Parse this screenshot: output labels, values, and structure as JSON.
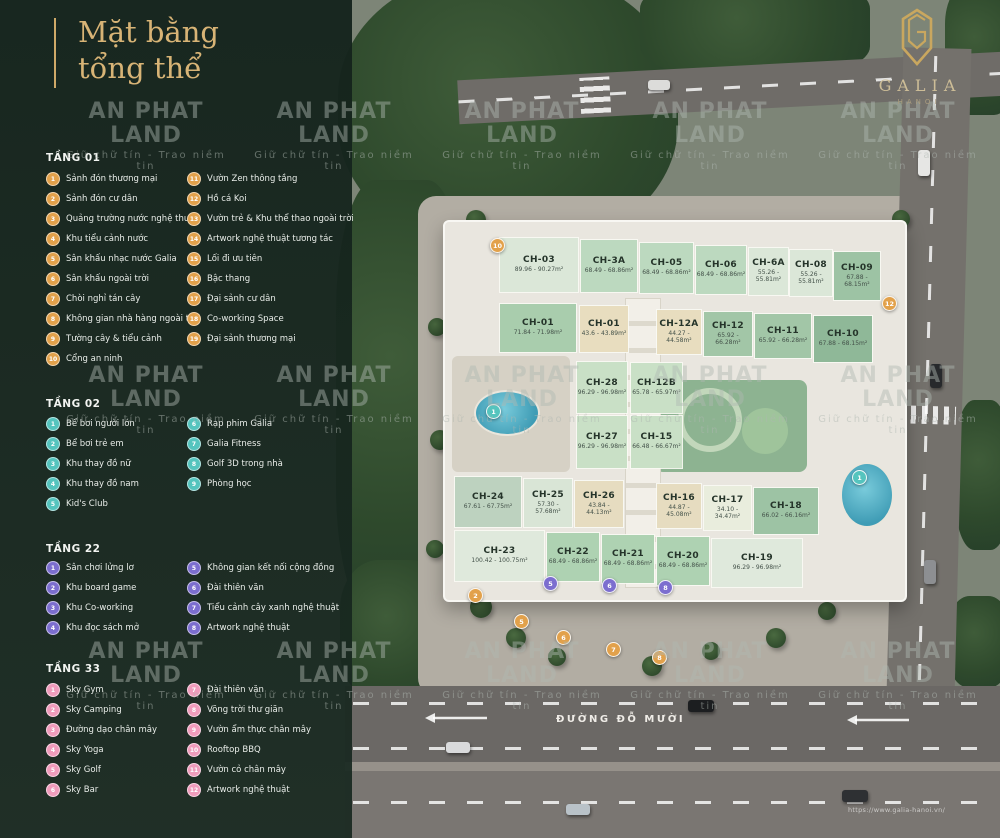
{
  "title": {
    "line1": "Mặt bằng",
    "line2": "tổng thể"
  },
  "logo": {
    "brand": "GALIA",
    "city": "HANOI"
  },
  "watermark": {
    "brand": "AN PHAT LAND",
    "tagline": "Giữ chữ tín  -  Trao niềm tin"
  },
  "legend_sections": [
    {
      "id": "tang-01",
      "title": "TẦNG 01",
      "circle_bg": "#E2A14B",
      "columns": [
        [
          {
            "n": "1",
            "label": "Sảnh đón thương mại"
          },
          {
            "n": "2",
            "label": "Sảnh đón cư dân"
          },
          {
            "n": "3",
            "label": "Quảng trường nước nghệ thuật"
          },
          {
            "n": "4",
            "label": "Khu tiểu cảnh nước"
          },
          {
            "n": "5",
            "label": "Sân khấu nhạc nước Galia"
          },
          {
            "n": "6",
            "label": "Sân khấu ngoài trời"
          },
          {
            "n": "7",
            "label": "Chòi nghỉ tán cây"
          },
          {
            "n": "8",
            "label": "Không gian nhà hàng ngoài trời"
          },
          {
            "n": "9",
            "label": "Tường cây & tiểu cảnh"
          },
          {
            "n": "10",
            "label": "Cổng an ninh"
          }
        ],
        [
          {
            "n": "11",
            "label": "Vườn Zen thông tầng"
          },
          {
            "n": "12",
            "label": "Hồ cá Koi"
          },
          {
            "n": "13",
            "label": "Vườn trẻ & Khu thể thao ngoài trời"
          },
          {
            "n": "14",
            "label": "Artwork nghệ thuật tương tác"
          },
          {
            "n": "15",
            "label": "Lối đi ưu tiên"
          },
          {
            "n": "16",
            "label": "Bậc thang"
          },
          {
            "n": "17",
            "label": "Đại sảnh cư dân"
          },
          {
            "n": "18",
            "label": "Co-working Space"
          },
          {
            "n": "19",
            "label": "Đại sảnh thương mại"
          }
        ]
      ]
    },
    {
      "id": "tang-02",
      "title": "TẦNG 02",
      "circle_bg": "#55C4BE",
      "columns": [
        [
          {
            "n": "1",
            "label": "Bể bơi người lớn"
          },
          {
            "n": "2",
            "label": "Bể bơi trẻ em"
          },
          {
            "n": "3",
            "label": "Khu thay đồ nữ"
          },
          {
            "n": "4",
            "label": "Khu thay đồ nam"
          },
          {
            "n": "5",
            "label": "Kid's Club"
          }
        ],
        [
          {
            "n": "6",
            "label": "Rạp phim Galia"
          },
          {
            "n": "7",
            "label": "Galia Fitness"
          },
          {
            "n": "8",
            "label": "Golf 3D trong nhà"
          },
          {
            "n": "9",
            "label": "Phòng học"
          }
        ]
      ]
    },
    {
      "id": "tang-22",
      "title": "TẦNG 22",
      "circle_bg": "#7C6ECF",
      "columns": [
        [
          {
            "n": "1",
            "label": "Sân chơi lửng lơ"
          },
          {
            "n": "2",
            "label": "Khu board game"
          },
          {
            "n": "3",
            "label": "Khu Co-working"
          },
          {
            "n": "4",
            "label": "Khu đọc sách mở"
          }
        ],
        [
          {
            "n": "5",
            "label": "Không gian kết nối cộng đồng"
          },
          {
            "n": "6",
            "label": "Đài thiên văn"
          },
          {
            "n": "7",
            "label": "Tiểu cảnh cây xanh nghệ thuật"
          },
          {
            "n": "8",
            "label": "Artwork nghệ thuật"
          }
        ]
      ]
    },
    {
      "id": "tang-33",
      "title": "TẦNG 33",
      "circle_bg": "#F09CBC",
      "columns": [
        [
          {
            "n": "1",
            "label": "Sky Gym"
          },
          {
            "n": "2",
            "label": "Sky Camping"
          },
          {
            "n": "3",
            "label": "Đường dạo chân mây"
          },
          {
            "n": "4",
            "label": "Sky Yoga"
          },
          {
            "n": "5",
            "label": "Sky Golf"
          },
          {
            "n": "6",
            "label": "Sky Bar"
          }
        ],
        [
          {
            "n": "7",
            "label": "Đài thiên văn"
          },
          {
            "n": "8",
            "label": "Võng trời thư giãn"
          },
          {
            "n": "9",
            "label": "Vườn ẩm thực chân mây"
          },
          {
            "n": "10",
            "label": "Rooftop BBQ"
          },
          {
            "n": "11",
            "label": "Vườn cỏ chân mây"
          },
          {
            "n": "12",
            "label": "Artwork nghệ thuật"
          }
        ]
      ]
    }
  ],
  "map": {
    "road_label": "ĐƯỜNG ĐỖ MƯỜI",
    "url": "https://www.galia-hanoi.vn/",
    "units": [
      {
        "id": "CH-03",
        "area": "89.96 - 90.27m²",
        "x": 500,
        "y": 238,
        "w": 78,
        "h": 54,
        "bg": "#dbe7d8"
      },
      {
        "id": "CH-3A",
        "area": "68.49 - 68.86m²",
        "x": 581,
        "y": 240,
        "w": 56,
        "h": 52,
        "bg": "#bcd9bf"
      },
      {
        "id": "CH-05",
        "area": "68.49 - 68.86m²",
        "x": 640,
        "y": 243,
        "w": 53,
        "h": 50,
        "bg": "#bcd9bf"
      },
      {
        "id": "CH-06",
        "area": "68.49 - 68.86m²",
        "x": 696,
        "y": 246,
        "w": 50,
        "h": 48,
        "bg": "#bcd9bf"
      },
      {
        "id": "CH-6A",
        "area": "55.26 - 55.81m²",
        "x": 749,
        "y": 248,
        "w": 39,
        "h": 47,
        "bg": "#dbe7d8"
      },
      {
        "id": "CH-08",
        "area": "55.26 - 55.81m²",
        "x": 790,
        "y": 250,
        "w": 42,
        "h": 46,
        "bg": "#dbe7d8"
      },
      {
        "id": "CH-09",
        "area": "67.88 - 68.15m²",
        "x": 834,
        "y": 252,
        "w": 46,
        "h": 48,
        "bg": "#9dc3a4"
      },
      {
        "id": "CH-01",
        "area": "71.84 - 71.98m²",
        "x": 500,
        "y": 304,
        "w": 76,
        "h": 48,
        "bg": "#a9cdad"
      },
      {
        "id": "CH-01",
        "area": "43.6 - 43.89m²",
        "x": 580,
        "y": 306,
        "w": 48,
        "h": 46,
        "bg": "#e8ddbf"
      },
      {
        "id": "CH-12A",
        "area": "44.27 - 44.58m²",
        "x": 657,
        "y": 310,
        "w": 44,
        "h": 44,
        "bg": "#e8ddbf"
      },
      {
        "id": "CH-12",
        "area": "65.92 - 66.28m²",
        "x": 704,
        "y": 312,
        "w": 48,
        "h": 44,
        "bg": "#a2c6a7"
      },
      {
        "id": "CH-11",
        "area": "65.92 - 66.28m²",
        "x": 755,
        "y": 314,
        "w": 56,
        "h": 44,
        "bg": "#a2c6a7"
      },
      {
        "id": "CH-10",
        "area": "67.88 - 68.15m²",
        "x": 814,
        "y": 316,
        "w": 58,
        "h": 46,
        "bg": "#8fb898"
      },
      {
        "id": "CH-28",
        "area": "96.29 - 96.98m²",
        "x": 577,
        "y": 362,
        "w": 50,
        "h": 51,
        "bg": "#c9e0c6"
      },
      {
        "id": "CH-12B",
        "area": "65.78 - 65.97m²",
        "x": 631,
        "y": 363,
        "w": 51,
        "h": 50,
        "bg": "#c9e0c6"
      },
      {
        "id": "CH-27",
        "area": "96.29 - 96.98m²",
        "x": 577,
        "y": 416,
        "w": 50,
        "h": 52,
        "bg": "#c9e0c6"
      },
      {
        "id": "CH-15",
        "area": "66.48 - 66.67m²",
        "x": 631,
        "y": 416,
        "w": 51,
        "h": 52,
        "bg": "#c9e0c6"
      },
      {
        "id": "CH-24",
        "area": "67.61 - 67.75m²",
        "x": 455,
        "y": 477,
        "w": 66,
        "h": 50,
        "bg": "#bdd2bf"
      },
      {
        "id": "CH-25",
        "area": "57.30 - 57.68m²",
        "x": 524,
        "y": 479,
        "w": 48,
        "h": 48,
        "bg": "#d9e5d6"
      },
      {
        "id": "CH-26",
        "area": "43.84 - 44.13m²",
        "x": 575,
        "y": 481,
        "w": 48,
        "h": 46,
        "bg": "#e6dcc0"
      },
      {
        "id": "CH-16",
        "area": "44.87 - 45.08m²",
        "x": 657,
        "y": 484,
        "w": 44,
        "h": 44,
        "bg": "#e6dcc0"
      },
      {
        "id": "CH-17",
        "area": "34.10 - 34.47m²",
        "x": 704,
        "y": 486,
        "w": 47,
        "h": 44,
        "bg": "#e9eddd"
      },
      {
        "id": "CH-18",
        "area": "66.02 - 66.16m²",
        "x": 754,
        "y": 488,
        "w": 64,
        "h": 46,
        "bg": "#9dc3a4"
      },
      {
        "id": "CH-23",
        "area": "100.42 - 100.75m²",
        "x": 455,
        "y": 531,
        "w": 89,
        "h": 50,
        "bg": "#dfe9dc"
      },
      {
        "id": "CH-22",
        "area": "68.49 - 68.86m²",
        "x": 547,
        "y": 533,
        "w": 52,
        "h": 48,
        "bg": "#aed2b2"
      },
      {
        "id": "CH-21",
        "area": "68.49 - 68.86m²",
        "x": 602,
        "y": 535,
        "w": 52,
        "h": 48,
        "bg": "#aed2b2"
      },
      {
        "id": "CH-20",
        "area": "68.49 - 68.86m²",
        "x": 657,
        "y": 537,
        "w": 52,
        "h": 48,
        "bg": "#aed2b2"
      },
      {
        "id": "CH-19",
        "area": "96.29 - 96.98m²",
        "x": 712,
        "y": 539,
        "w": 90,
        "h": 48,
        "bg": "#dfe9dc"
      }
    ],
    "markers": [
      {
        "n": "10",
        "color": "#E2A14B",
        "x": 490,
        "y": 238
      },
      {
        "n": "12",
        "color": "#E2A14B",
        "x": 882,
        "y": 296
      },
      {
        "n": "2",
        "color": "#E2A14B",
        "x": 468,
        "y": 588
      },
      {
        "n": "5",
        "color": "#E2A14B",
        "x": 514,
        "y": 614
      },
      {
        "n": "6",
        "color": "#E2A14B",
        "x": 556,
        "y": 630
      },
      {
        "n": "7",
        "color": "#E2A14B",
        "x": 606,
        "y": 642
      },
      {
        "n": "8",
        "color": "#E2A14B",
        "x": 652,
        "y": 650
      },
      {
        "n": "1",
        "color": "#55C4BE",
        "x": 486,
        "y": 404
      },
      {
        "n": "1",
        "color": "#55C4BE",
        "x": 852,
        "y": 470
      },
      {
        "n": "5",
        "color": "#7C6ECF",
        "x": 543,
        "y": 576
      },
      {
        "n": "6",
        "color": "#7C6ECF",
        "x": 602,
        "y": 578
      },
      {
        "n": "8",
        "color": "#7C6ECF",
        "x": 658,
        "y": 580
      }
    ]
  }
}
